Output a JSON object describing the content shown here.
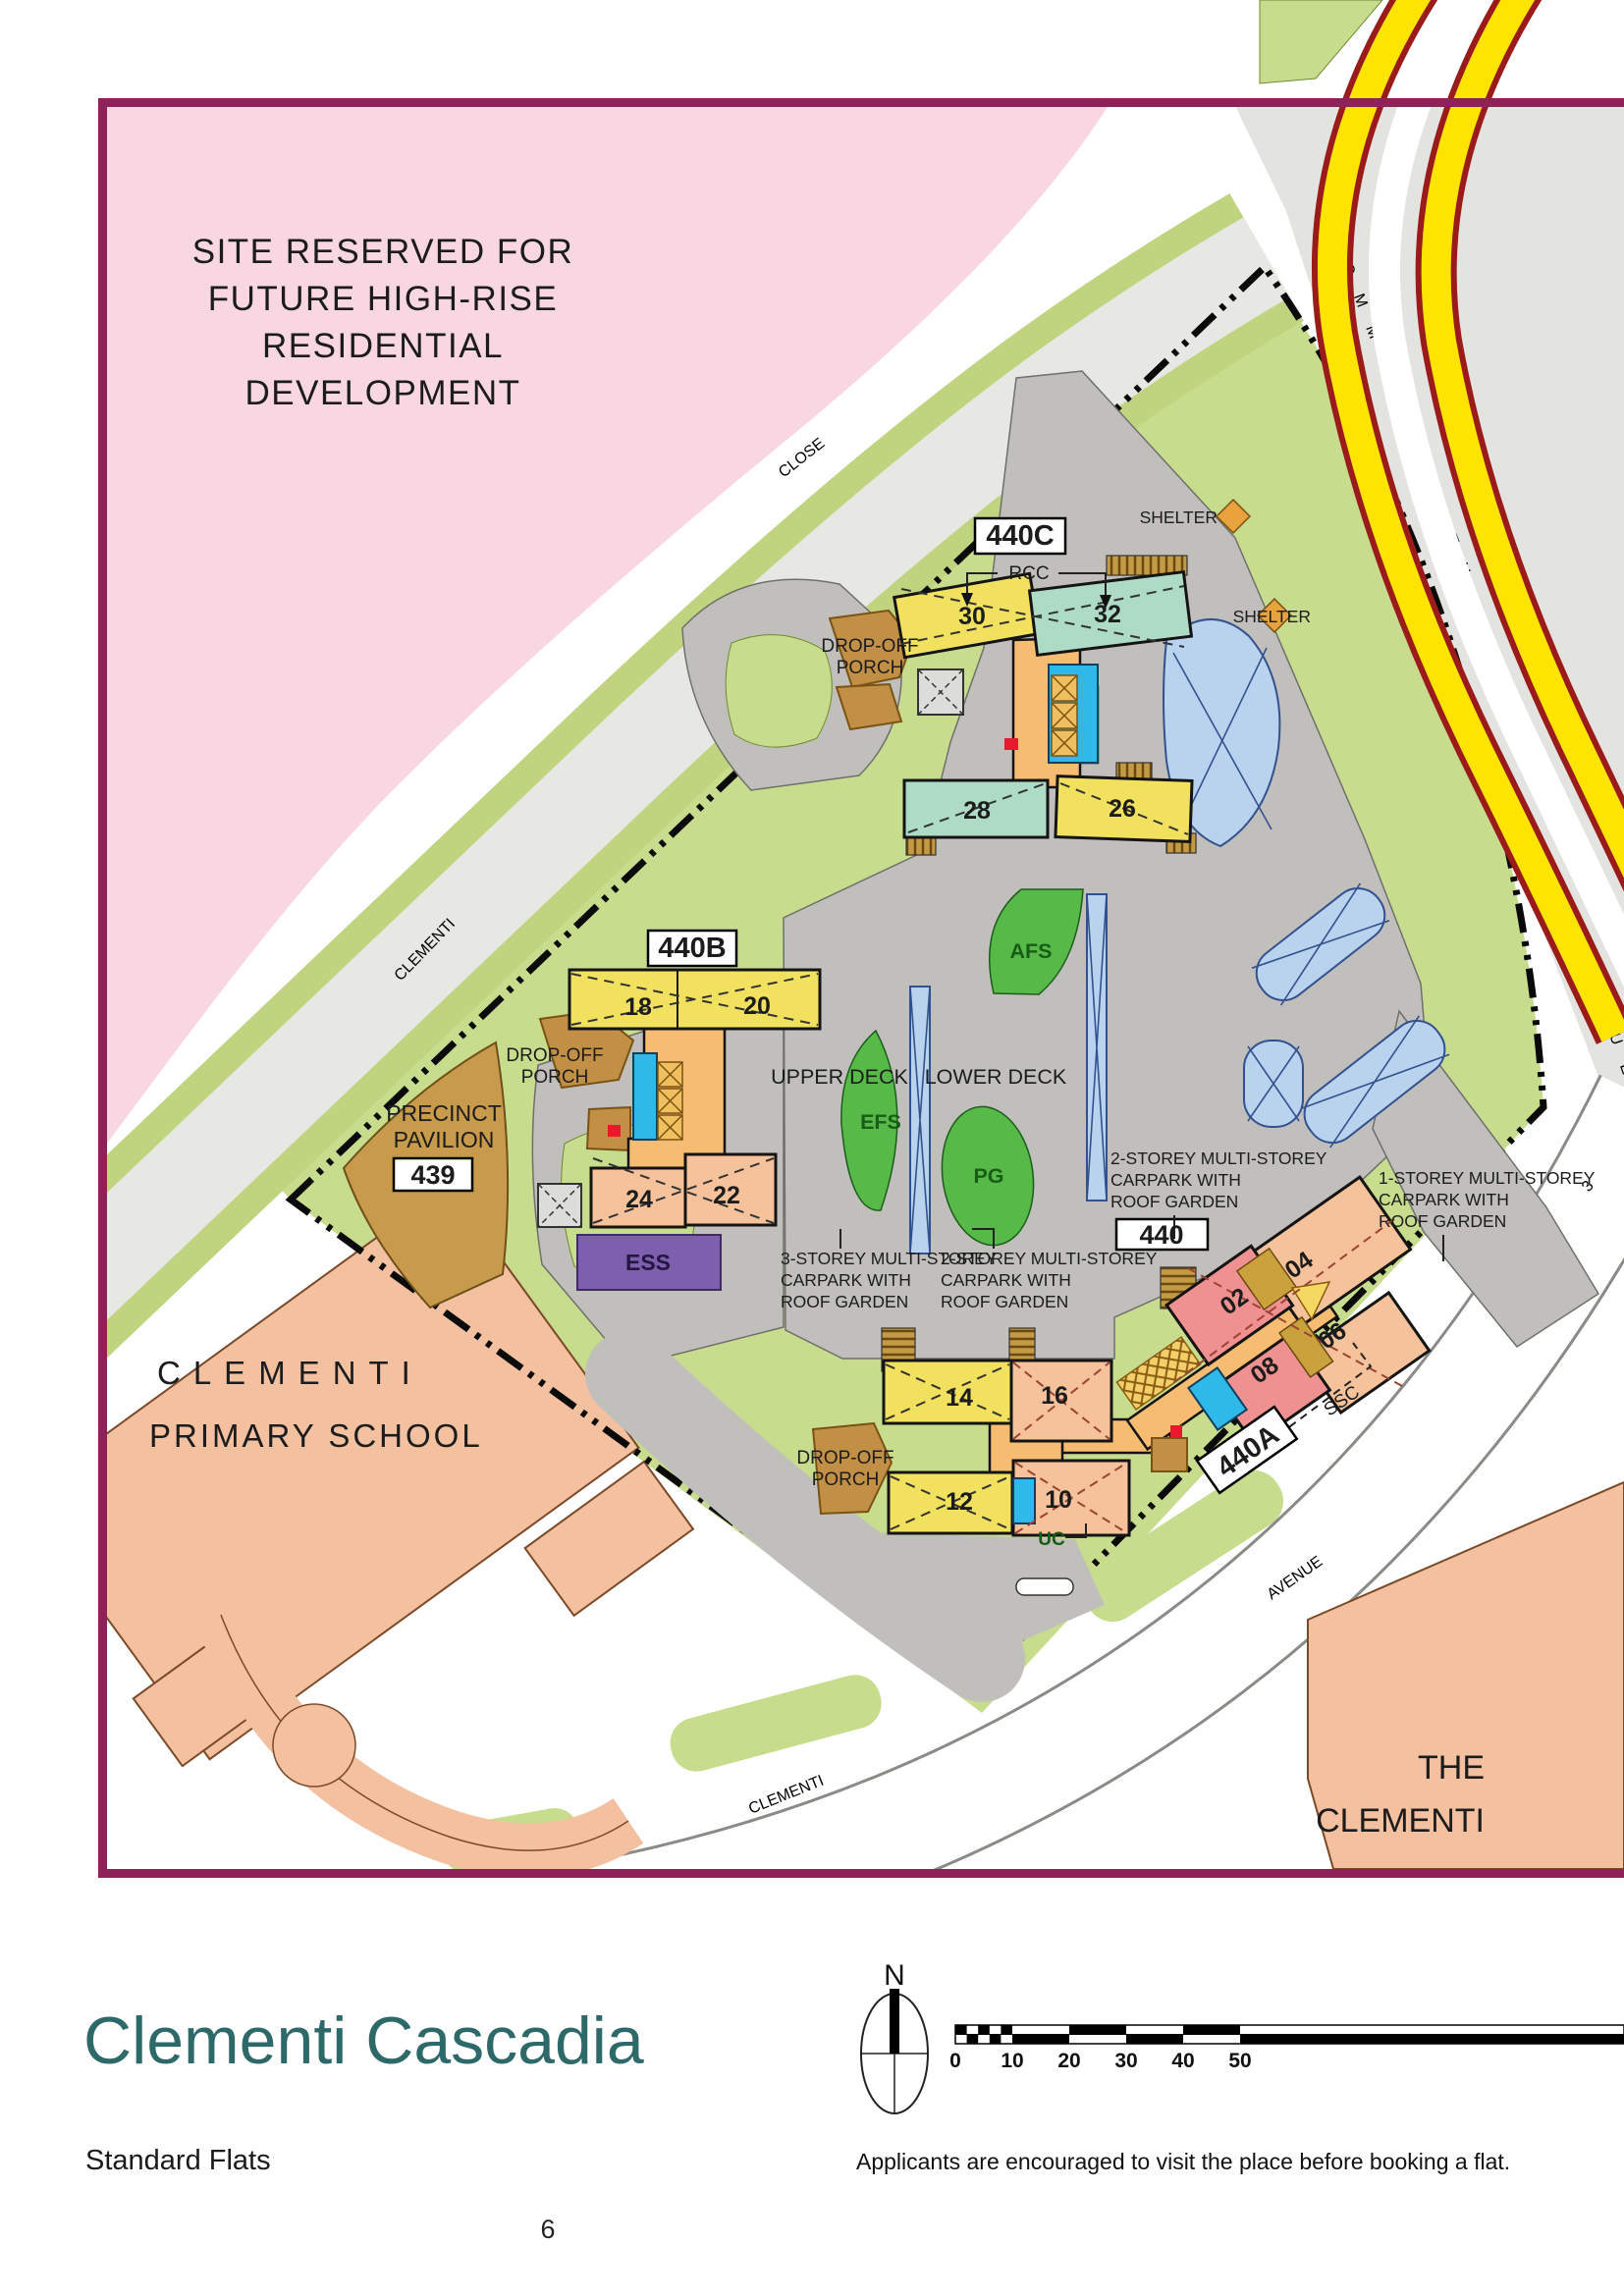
{
  "legend": {
    "title": "Clementi Cascadia",
    "subtitle": "Standard Flats",
    "note": "Applicants are encouraged to visit the place before booking a flat.",
    "page_number": "6",
    "north": "N",
    "ticks": [
      "0",
      "10",
      "20",
      "30",
      "40",
      "50"
    ]
  },
  "map": {
    "reserved": {
      "l1": "SITE RESERVED FOR",
      "l2": "FUTURE HIGH-RISE",
      "l3": "RESIDENTIAL",
      "l4": "DEVELOPMENT"
    },
    "roads": {
      "clementi": "CLEMENTI",
      "close": "CLOSE",
      "commonwealth": "COMMONWEALTH",
      "commonwealth_ave": "AVENUE",
      "ave3_name": "CLEMENTI",
      "ave3_ave": "AVENUE",
      "ave3_num": "3"
    },
    "school": {
      "l1": "CLEMENTI",
      "l2": "PRIMARY SCHOOL"
    },
    "neighbor": {
      "l1": "THE",
      "l2": "CLEMENTI"
    },
    "labels": {
      "b440c": "440C",
      "b440b": "440B",
      "b440a": "440A",
      "b440": "440",
      "b439": "439",
      "rcc": "RCC",
      "ssc": "SSC",
      "uc": "UC",
      "ess": "ESS",
      "shelter1": "SHELTER",
      "shelter2": "SHELTER",
      "pav1": "PRECINCT",
      "pav2": "PAVILION",
      "upper_deck": "UPPER DECK",
      "lower_deck": "LOWER DECK",
      "efs": "EFS",
      "pg": "PG",
      "afs": "AFS"
    },
    "blocks": {
      "b30": "30",
      "b32": "32",
      "b28": "28",
      "b26": "26",
      "b18": "18",
      "b20": "20",
      "b24": "24",
      "b22": "22",
      "b14": "14",
      "b16": "16",
      "b12": "12",
      "b10": "10",
      "b02": "02",
      "b04": "04",
      "b06": "06",
      "b08": "08"
    },
    "dropoff": {
      "p1l1": "DROP-OFF",
      "p1l2": "PORCH",
      "p2l1": "DROP-OFF",
      "p2l2": "PORCH",
      "p3l1": "DROP-OFF",
      "p3l2": "PORCH"
    },
    "carparks": {
      "cp3": {
        "l1": "3-STOREY MULTI-STOREY",
        "l2": "CARPARK WITH",
        "l3": "ROOF GARDEN"
      },
      "cp2a": {
        "l1": "2-STOREY MULTI-STOREY",
        "l2": "CARPARK WITH",
        "l3": "ROOF GARDEN"
      },
      "cp2b": {
        "l1": "2-STOREY MULTI-STOREY",
        "l2": "CARPARK WITH",
        "l3": "ROOF GARDEN"
      },
      "cp1": {
        "l1": "1-STOREY MULTI-STOREY",
        "l2": "CARPARK WITH",
        "l3": "ROOF GARDEN"
      }
    },
    "colors": {
      "frame": "#8e2157",
      "title": "#2e6969",
      "reserved_fill": "#f8d7e3",
      "site_green": "#c8dc8d",
      "deck_gray": "#c0bfbc",
      "stripe_yellow": "#ffe400"
    }
  }
}
